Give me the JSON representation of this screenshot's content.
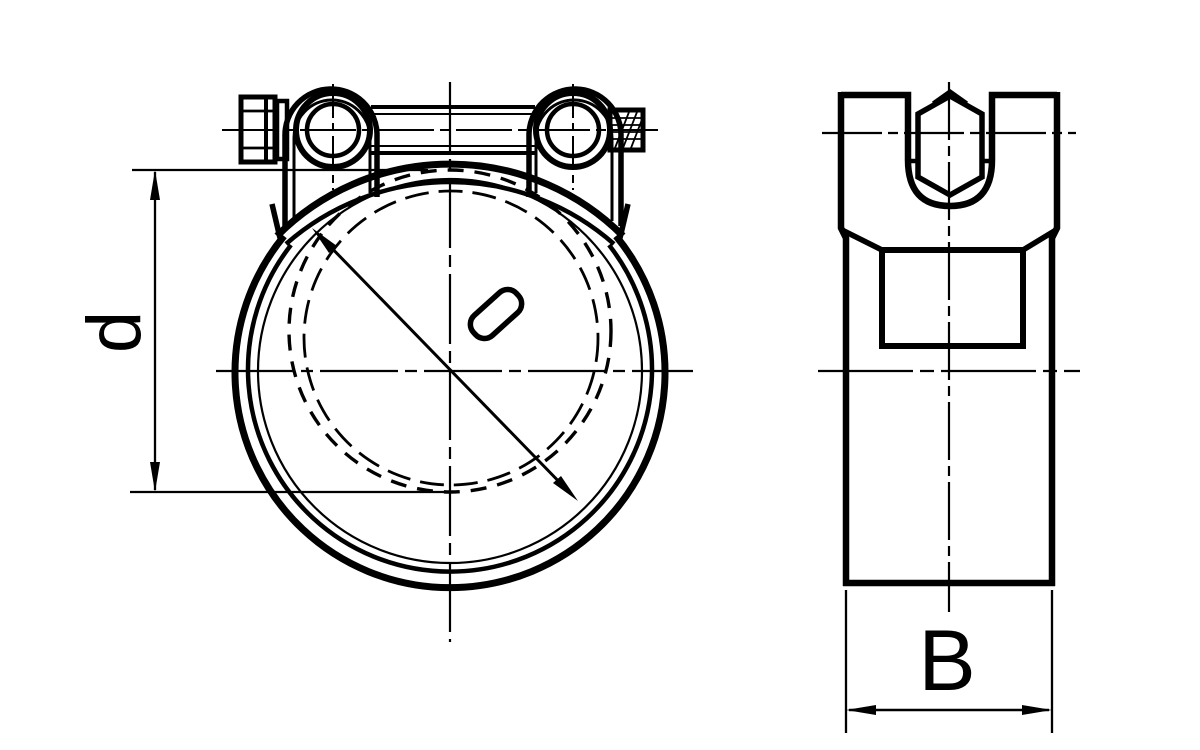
{
  "drawing": {
    "type": "technical drawing",
    "subject": "heavy-duty hose clamp, front and side views",
    "background_color": "#ffffff",
    "line_color": "#000000",
    "front_view": {
      "dimension_label": "d"
    },
    "side_view": {
      "dimension_label": "B"
    }
  }
}
